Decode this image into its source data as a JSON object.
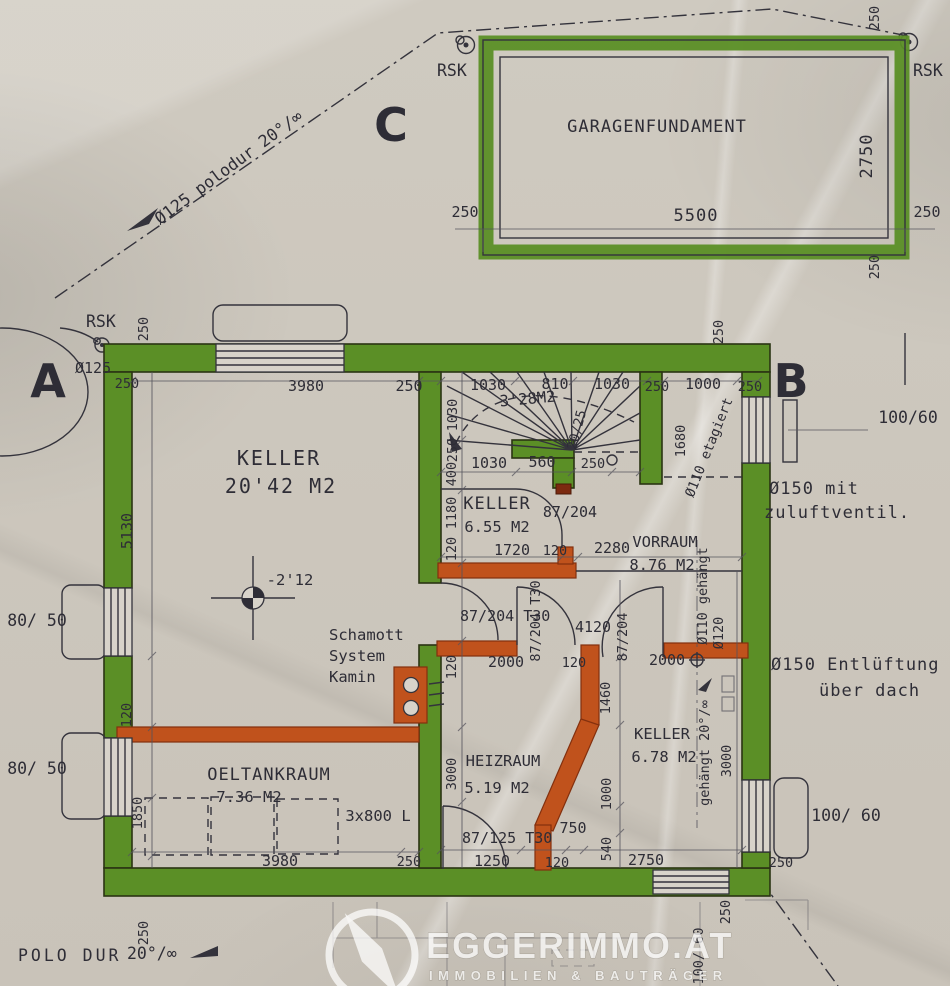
{
  "colors": {
    "wall_green": "#5b8f26",
    "wall_orange": "#c0521c",
    "ink": "#2e2d36",
    "paper": "#cfcac0"
  },
  "site": {
    "a": "A",
    "b": "B",
    "c": "C",
    "rsk1": "RSK",
    "rsk2": "RSK",
    "rsk3": "RSK",
    "pipe_diag": "Ø125 polodur 20°/∞",
    "o125": "Ø125",
    "polodur": "POLO DUR",
    "slope": "20°/∞"
  },
  "garage": {
    "title": "GARAGENFUNDAMENT",
    "d5500": "5500",
    "d2750": "2750",
    "d250l": "250",
    "d250r": "250",
    "d250tr": "250",
    "d250br": "250"
  },
  "rooms": {
    "keller1": {
      "name": "KELLER",
      "area": "20'42 M2"
    },
    "keller2": {
      "name": "KELLER",
      "area": "6.55 M2"
    },
    "keller3": {
      "name": "KELLER",
      "area": "6.78 M2"
    },
    "vorraum": {
      "name": "VORRAUM",
      "area": "8.76 M2"
    },
    "heizraum": {
      "name": "HEIZRAUM",
      "area": "5.19 M2"
    },
    "oeltankraum": {
      "name": "OELTANKRAUM",
      "area": "7.36 M2",
      "tanks": "3x800 L"
    },
    "stair": {
      "area": "3'28M2",
      "step": "20/25"
    },
    "level": "-2'12",
    "kamin1": "Schamott",
    "kamin2": "System",
    "kamin3": "Kamin"
  },
  "doors": {
    "k2": "87/204",
    "v1": "87/204 T30",
    "v2": "87/204 T30",
    "v3": "87/204",
    "hz": "87/125 T30"
  },
  "windows": {
    "left1": "80/ 50",
    "left2": "80/ 50",
    "right1": "100/60",
    "right2": "100/ 60",
    "bottom": "100/ 60"
  },
  "pipes": {
    "zuluft1": "Ø150 mit",
    "zuluft2": "zuluftventil.",
    "entlueft1": "Ø150 Entlüftung",
    "entlueft2": "über dach",
    "etagiert": "Ø110 etagiert",
    "d1680": "1680",
    "gehaengt1": "Ø110 gehängt",
    "d120": "Ø120",
    "gehaengt2": "gehängt 20°/∞"
  },
  "dims": {
    "top3980": "3980",
    "top250a": "250",
    "st1030a": "1030",
    "st810": "810",
    "st1030b": "1030",
    "top250b": "250",
    "top1000": "1000",
    "top250c": "250",
    "tl250v": "250",
    "tl250": "250",
    "tr250v": "250",
    "stv1030": "1030",
    "stv250": "250",
    "sb1030": "1030",
    "sb560": "560",
    "sb250": "250",
    "c400": "400",
    "c1180": "1180",
    "c120a": "120",
    "k1720": "1720",
    "k120": "120",
    "k2280": "2280",
    "l5130": "5130",
    "l120": "120",
    "l1850": "1850",
    "m4120": "4120",
    "m120v": "120",
    "m2000a": "2000",
    "m120": "120",
    "m2000b": "2000",
    "r1460": "1460",
    "r1000": "1000",
    "r3000": "3000",
    "h3000": "3000",
    "h750": "750",
    "h540": "540",
    "b3980": "3980",
    "b250a": "250",
    "b1250": "1250",
    "b120": "120",
    "b2750": "2750",
    "b250r": "250",
    "b250v": "250",
    "b250l": "250"
  },
  "footer": {
    "brand": "EGGERIMMO.AT",
    "tagline": "IMMOBILIEN & BAUTRÄGER"
  }
}
